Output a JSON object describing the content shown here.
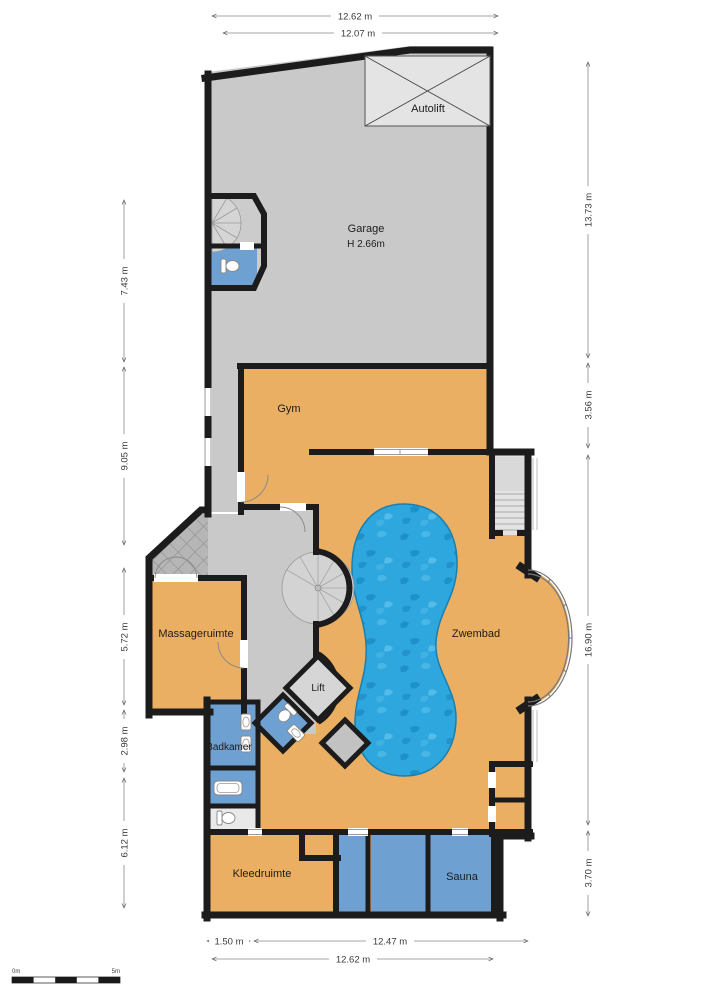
{
  "floorplan": {
    "rooms": {
      "garage": {
        "label": "Garage",
        "height": "H 2.66m"
      },
      "autolift": {
        "label": "Autolift"
      },
      "gym": {
        "label": "Gym"
      },
      "zwembad": {
        "label": "Zwembad"
      },
      "massageruimte": {
        "label": "Massageruimte"
      },
      "lift": {
        "label": "Lift"
      },
      "badkamer": {
        "label": "Badkamer"
      },
      "kleedruimte": {
        "label": "Kleedruimte"
      },
      "sauna": {
        "label": "Sauna"
      }
    },
    "dimensions": {
      "top": [
        "12.62 m",
        "12.07 m"
      ],
      "bottom": [
        "1.50 m",
        "12.47 m",
        "12.62 m"
      ],
      "left": [
        "7.43 m",
        "9.05 m",
        "5.72 m",
        "2.98 m",
        "6.12 m"
      ],
      "right": [
        "13.73 m",
        "3.56 m",
        "16.90 m",
        "3.70 m"
      ]
    },
    "scale_bar": {
      "start": "0m",
      "end": "5m"
    },
    "colors": {
      "wall": "#1c1c1c",
      "floor_gray": "#c9c9c9",
      "room_orange": "#eaaf63",
      "room_blue": "#6fa0d2",
      "pool_blue": "#2ea6de",
      "background": "#ffffff"
    }
  }
}
